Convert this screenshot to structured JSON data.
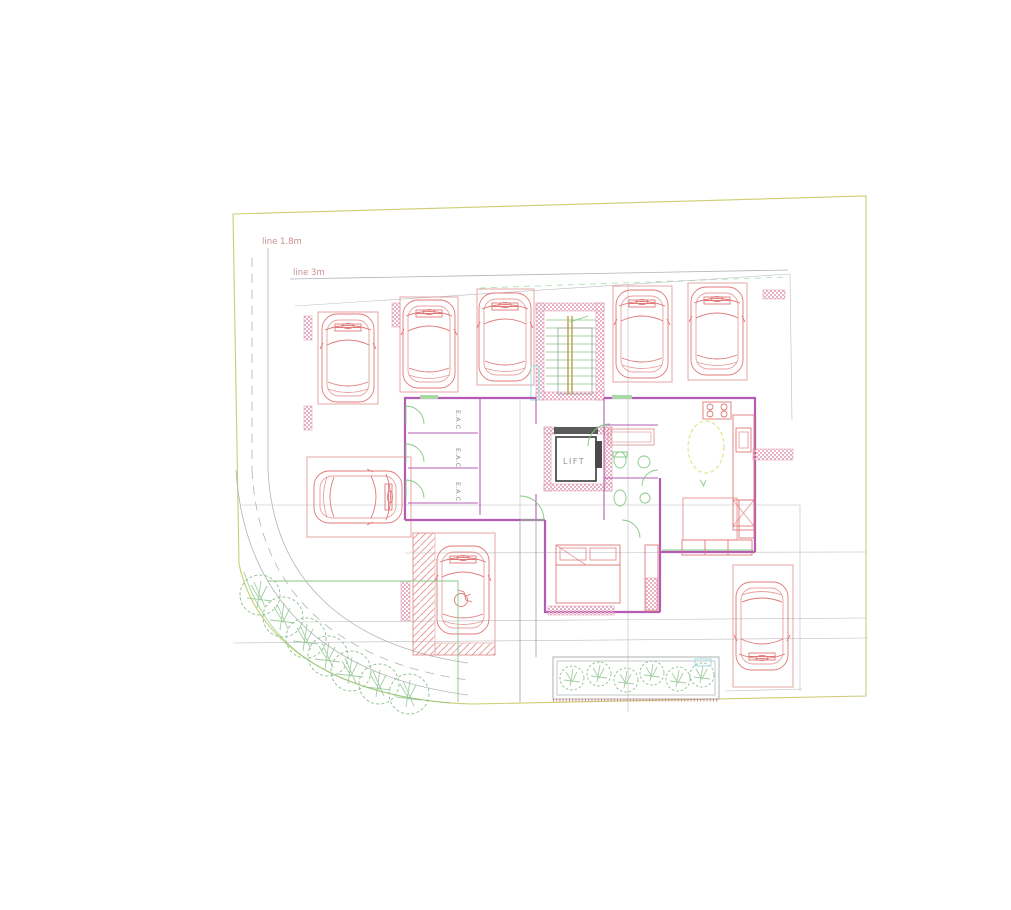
{
  "plan": {
    "title": "ground-floor-site-plan",
    "labels": {
      "setback_small": "line 1.8m",
      "setback_large": "line 3m",
      "lift": "LIFT",
      "storage_room": "E.A.C"
    },
    "counts": {
      "cars": 8,
      "parking_stalls_top_row": 5,
      "storage_rooms": 3,
      "corner_shrubs": 7
    },
    "colors": {
      "site_boundary": "#cdcd74",
      "kerb_and_dims": "#b2b2ba",
      "parking_and_cars": "#e07878",
      "walls": "#b45cb4",
      "wall_hatch": "#eab0c4",
      "doors_and_fixtures": "#86c886",
      "stair_treads": "#a4d4a4",
      "stair_rail": "#b8a048",
      "shrubs": "#8cc08c",
      "dining_table": "#e4e488",
      "water_marks": "#9adce0",
      "annotation_text": "#c98f8f",
      "lift_text": "#8f8f8f"
    }
  }
}
